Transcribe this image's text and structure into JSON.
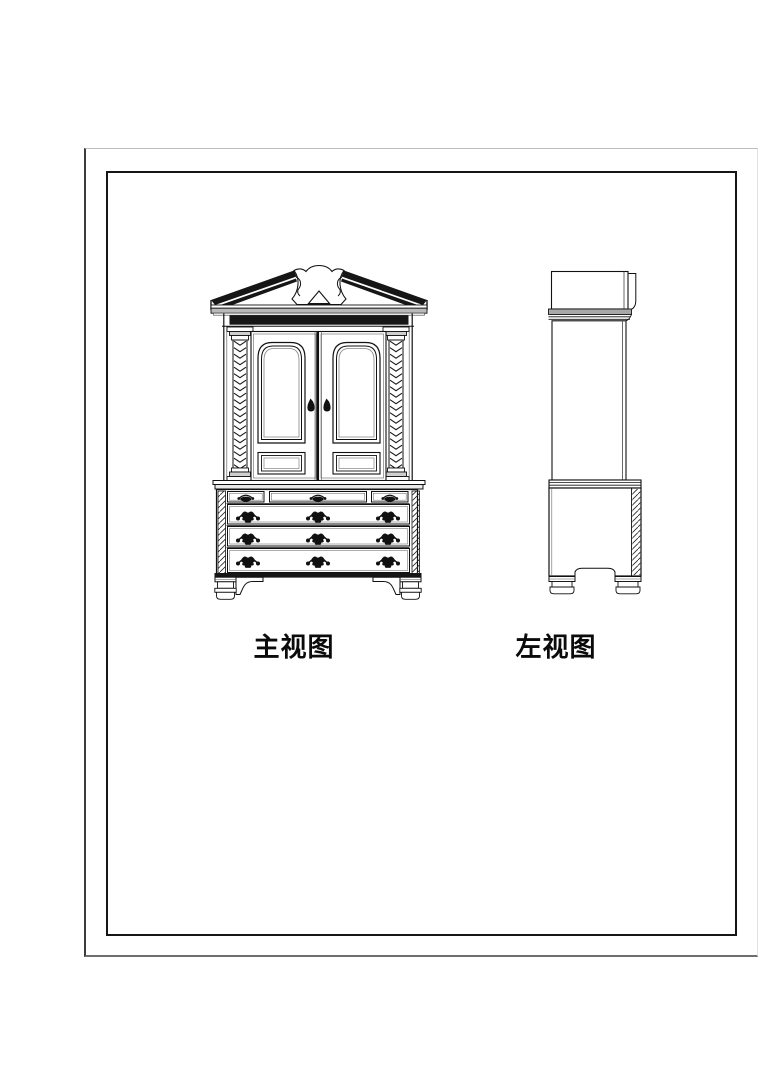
{
  "sheet": {
    "background_color": "#ffffff",
    "outer_border_color": "#6e6e6e",
    "inner_border_color": "#161616",
    "line_color": "#1a1a1a"
  },
  "views": {
    "front": {
      "label": "主视图"
    },
    "side": {
      "label": "左视图"
    }
  }
}
